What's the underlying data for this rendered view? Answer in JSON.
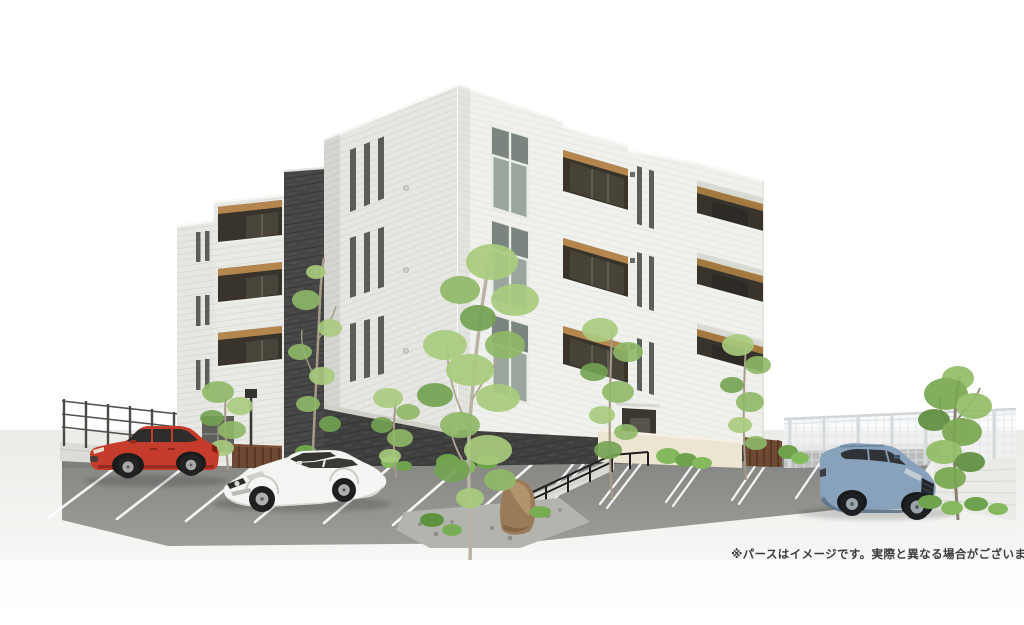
{
  "disclaimer": {
    "text": "※パースはイメージです。実際と異なる場合がございます。"
  },
  "scene": {
    "type": "architectural-exterior-rendering",
    "building": {
      "stories": 4,
      "wall_finish": "white brick",
      "accent": "dark gray brick core and base",
      "balcony_ceiling": "wood"
    },
    "cars": [
      {
        "id": "red-suv",
        "color_name": "red"
      },
      {
        "id": "white-sedan",
        "color_name": "white"
      },
      {
        "id": "blue-suv",
        "color_name": "blue-gray"
      }
    ],
    "trees": 7,
    "parking": {
      "stall_lines_left": 7,
      "stall_lines_right": 6
    }
  },
  "colors": {
    "background": "#ffffff",
    "ground": "#f3f3f1",
    "asphalt": "#8f908e",
    "walk": "#d8d8d4",
    "wall_light": "#e6e7e2",
    "wall_lighter": "#f0f1ed",
    "wall_dark": "#474747",
    "base_brick": "#3f3f3e",
    "wood": "#b5854e",
    "opening_dark": "#38342c",
    "glass_dark": "#474338",
    "glass_light": "#9aa59e",
    "mullion": "#eceee9",
    "cream_wall": "#ece5d2",
    "gate_brown": "#6e4a35",
    "railing": "#1f1f1f",
    "fence_dark": "#55544f",
    "fence_light": "#dfe3e5",
    "stall_line": "#ffffff",
    "car_red": "#c63c2c",
    "car_white": "#f5f5f3",
    "car_blue": "#89a2bb",
    "leaf": "#85b35d",
    "leaf_light": "#a9cc7e",
    "leaf_dark": "#6a9a48",
    "trunk": "#a99f8c",
    "rock": "#9b7a58",
    "text": "#3c3c3c"
  }
}
